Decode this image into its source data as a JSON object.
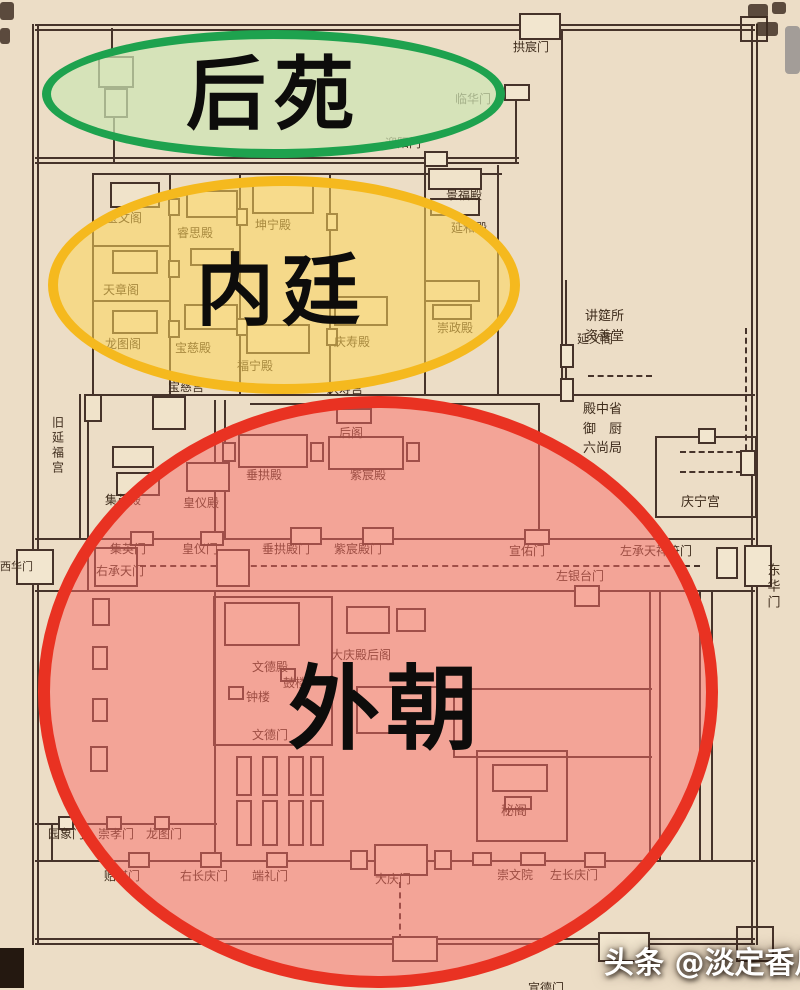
{
  "title": "annotated palace plan",
  "zones": [
    {
      "label": "后苑",
      "stroke": "#1ea24e",
      "fill": "rgba(205,228,180,0.72)"
    },
    {
      "label": "内廷",
      "stroke": "#f5b91e",
      "fill": "rgba(254,213,89,0.55)"
    },
    {
      "label": "外朝",
      "stroke": "#e93222",
      "fill": "rgba(250,107,104,0.5)"
    }
  ],
  "watermark": {
    "text": "头条 @淡定香瓜o1",
    "color": "#ffffff"
  },
  "colors": {
    "page_background": "#ecddc6",
    "map_line": "#46332a",
    "scrollbar": "#a39d98"
  },
  "map": {
    "labels": [
      {
        "t": "拱宸门",
        "x": 513,
        "y": 41
      },
      {
        "t": "临华门",
        "x": 455,
        "y": 93
      },
      {
        "t": "迎阳门",
        "x": 385,
        "y": 137
      },
      {
        "t": "景福殿",
        "x": 446,
        "y": 189
      },
      {
        "t": "延和殿",
        "x": 451,
        "y": 222
      },
      {
        "t": "宝文阁",
        "x": 106,
        "y": 212
      },
      {
        "t": "睿思殿",
        "x": 177,
        "y": 227
      },
      {
        "t": "坤宁殿",
        "x": 255,
        "y": 219
      },
      {
        "t": "天章阁",
        "x": 103,
        "y": 284
      },
      {
        "t": "龙图阁",
        "x": 105,
        "y": 338
      },
      {
        "t": "宝慈殿",
        "x": 175,
        "y": 342
      },
      {
        "t": "福宁殿",
        "x": 237,
        "y": 360
      },
      {
        "t": "庆寿殿",
        "x": 334,
        "y": 336
      },
      {
        "t": "崇政殿",
        "x": 437,
        "y": 322
      },
      {
        "t": "延义阁",
        "x": 577,
        "y": 333
      },
      {
        "t": "讲筵所",
        "x": 585,
        "y": 310,
        "s": 13
      },
      {
        "t": "资善堂",
        "x": 585,
        "y": 330,
        "s": 13
      },
      {
        "t": "宝慈宫",
        "x": 168,
        "y": 381
      },
      {
        "t": "庆寿宫",
        "x": 327,
        "y": 383
      },
      {
        "t": "殿中省",
        "x": 583,
        "y": 403,
        "s": 13
      },
      {
        "t": "御　厨",
        "x": 583,
        "y": 423,
        "s": 13
      },
      {
        "t": "六尚局",
        "x": 583,
        "y": 442,
        "s": 13
      },
      {
        "t": "旧延福宫",
        "x": 50,
        "y": 416,
        "v": 1
      },
      {
        "t": "庆宁宫",
        "x": 681,
        "y": 496,
        "s": 13
      },
      {
        "t": "后阁",
        "x": 339,
        "y": 427
      },
      {
        "t": "垂拱殿",
        "x": 246,
        "y": 469
      },
      {
        "t": "紫宸殿",
        "x": 350,
        "y": 469
      },
      {
        "t": "集英殿",
        "x": 105,
        "y": 494
      },
      {
        "t": "皇仪殿",
        "x": 183,
        "y": 497
      },
      {
        "t": "集英门",
        "x": 110,
        "y": 543
      },
      {
        "t": "皇仪门",
        "x": 182,
        "y": 543
      },
      {
        "t": "垂拱殿门",
        "x": 262,
        "y": 543
      },
      {
        "t": "紫宸殿门",
        "x": 334,
        "y": 543
      },
      {
        "t": "宣佑门",
        "x": 509,
        "y": 545
      },
      {
        "t": "左承天祥符门",
        "x": 620,
        "y": 545
      },
      {
        "t": "右承天门",
        "x": 96,
        "y": 565
      },
      {
        "t": "西华门",
        "x": 0,
        "y": 561,
        "s": 11
      },
      {
        "t": "左银台门",
        "x": 556,
        "y": 570
      },
      {
        "t": "东华门",
        "x": 764,
        "y": 563,
        "v": 1,
        "s": 13
      },
      {
        "t": "文德殿",
        "x": 252,
        "y": 661
      },
      {
        "t": "大庆殿后阁",
        "x": 331,
        "y": 649
      },
      {
        "t": "鼓楼",
        "x": 283,
        "y": 677
      },
      {
        "t": "钟楼",
        "x": 246,
        "y": 691
      },
      {
        "t": "文德门",
        "x": 252,
        "y": 729
      },
      {
        "t": "秘阁",
        "x": 501,
        "y": 805,
        "s": 13
      },
      {
        "t": "园象门",
        "x": 48,
        "y": 828
      },
      {
        "t": "崇孝门",
        "x": 98,
        "y": 828
      },
      {
        "t": "龙图门",
        "x": 146,
        "y": 828
      },
      {
        "t": "贻谋门",
        "x": 104,
        "y": 870
      },
      {
        "t": "右长庆门",
        "x": 180,
        "y": 870
      },
      {
        "t": "端礼门",
        "x": 252,
        "y": 870
      },
      {
        "t": "大庆门",
        "x": 375,
        "y": 873
      },
      {
        "t": "崇文院",
        "x": 497,
        "y": 869
      },
      {
        "t": "左长庆门",
        "x": 550,
        "y": 869
      },
      {
        "t": "宣德门",
        "x": 528,
        "y": 982
      }
    ]
  }
}
